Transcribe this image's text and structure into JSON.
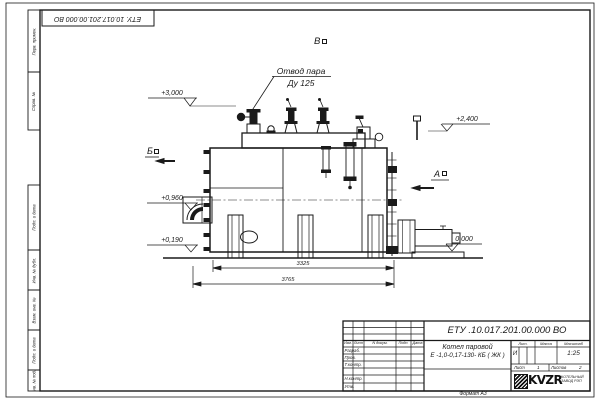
{
  "sheet": {
    "doc_ref_rotated": "ЕТУ. 10.017.201.00.000  ВО",
    "format_note": "Формат  А3"
  },
  "margin_columns": [
    "Перв. примен.",
    "Справ. №",
    "Подп. и дата",
    "Инв. № дубл.",
    "Взам. инв. №",
    "Подп. и дата",
    "Инв. № подл."
  ],
  "annotations": {
    "steam_outlet_line1": "Отвод пара",
    "steam_outlet_line2": "Ду 125",
    "view_top": "В",
    "view_left": "Б",
    "view_right": "А",
    "elev_top_left": "+3,000",
    "elev_top_right": "+2,400",
    "elev_mid_left": "+0,960",
    "elev_low_left": "+0,190",
    "elev_ground": "0,000",
    "dim_inner": "3325",
    "dim_outer": "3765"
  },
  "title_block": {
    "doc_number": "ЕТУ .10.017.201.00.000  ВО",
    "name_line1": "Котел паровой",
    "name_line2": "Е -1,0-0,17-130- КБ ( ЖК )",
    "columns": [
      "Изм.",
      "Лист",
      "N докум.",
      "Подп.",
      "Дата"
    ],
    "rows": [
      "Разраб.",
      "Пров.",
      "Т.контр.",
      "Н.контр.",
      "Утв."
    ],
    "lit_header": "Лит.",
    "mass_header": "Масса",
    "scale_header": "Масштаб",
    "lit_value": "И",
    "scale_value": "1:25",
    "sheet_label": "Лист",
    "sheet_value": "1",
    "sheets_label": "Листов",
    "sheets_value": "2",
    "logo": "KVZR",
    "logo_sub1": "КОТЕЛЬНЫЙ",
    "logo_sub2": "ЗАВОД РЭП"
  }
}
